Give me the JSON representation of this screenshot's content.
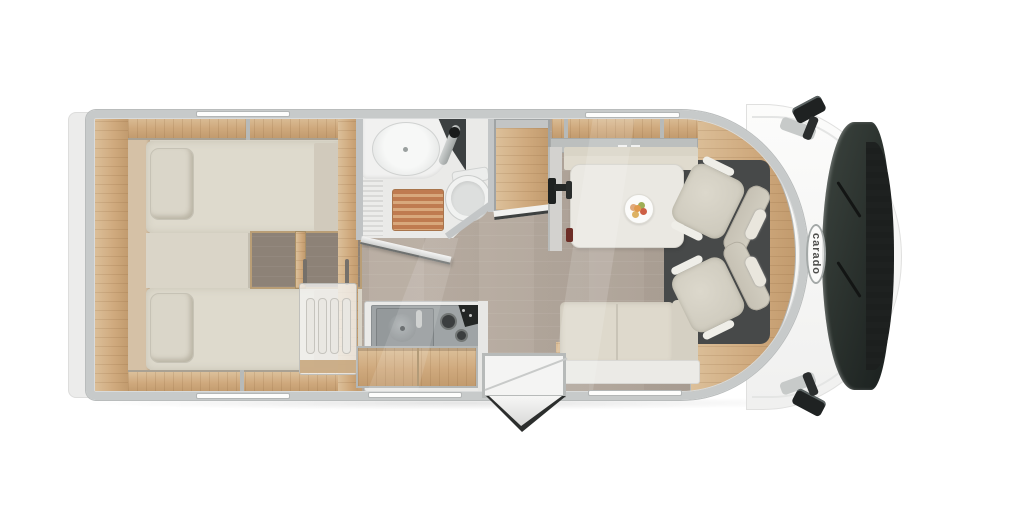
{
  "brand": {
    "logo_text": "carado"
  },
  "scene": {
    "type": "motorhome-floorplan-top-view",
    "orientation": "rear-left_cab-right",
    "areas": [
      "rear-twin-bedroom",
      "bathroom",
      "wardrobe",
      "kitchen",
      "dinette",
      "entry-door",
      "driver-cab"
    ],
    "fixtures": [
      "twin-bed-top",
      "twin-bed-bottom",
      "pillows",
      "center-steps",
      "overhead-cabinets",
      "washbasin",
      "faucet",
      "toilet",
      "shower-duckboard",
      "bathroom-door-open",
      "wardrobe-door-open",
      "kitchen-sink",
      "two-burner-hob",
      "kitchen-drawer",
      "dish-rack",
      "dinette-table",
      "fruit-plate",
      "bench-seat-front",
      "bench-seat-rear",
      "tv-mount",
      "swivel-seat-driver",
      "swivel-seat-passenger",
      "entry-step",
      "entry-door-open",
      "windshield",
      "wipers",
      "side-mirror-left",
      "side-mirror-right",
      "window-markers"
    ],
    "window_count": 5
  },
  "colors": {
    "wall": "#c7caca",
    "bumper": "#ececeb",
    "wood": "#cfa97d",
    "woodlight": "#dcc09a",
    "floor": "#b1a79c",
    "floordark": "#8d8277",
    "mattress": "#dedacd",
    "table": "#eae8e2",
    "bathfloor": "#eaeae8",
    "steel": "#9fa4a6",
    "slats": "#bf7b50",
    "windshield": "#2c332f",
    "seat": "#cbc7ba",
    "cabfloor": "#474949"
  }
}
